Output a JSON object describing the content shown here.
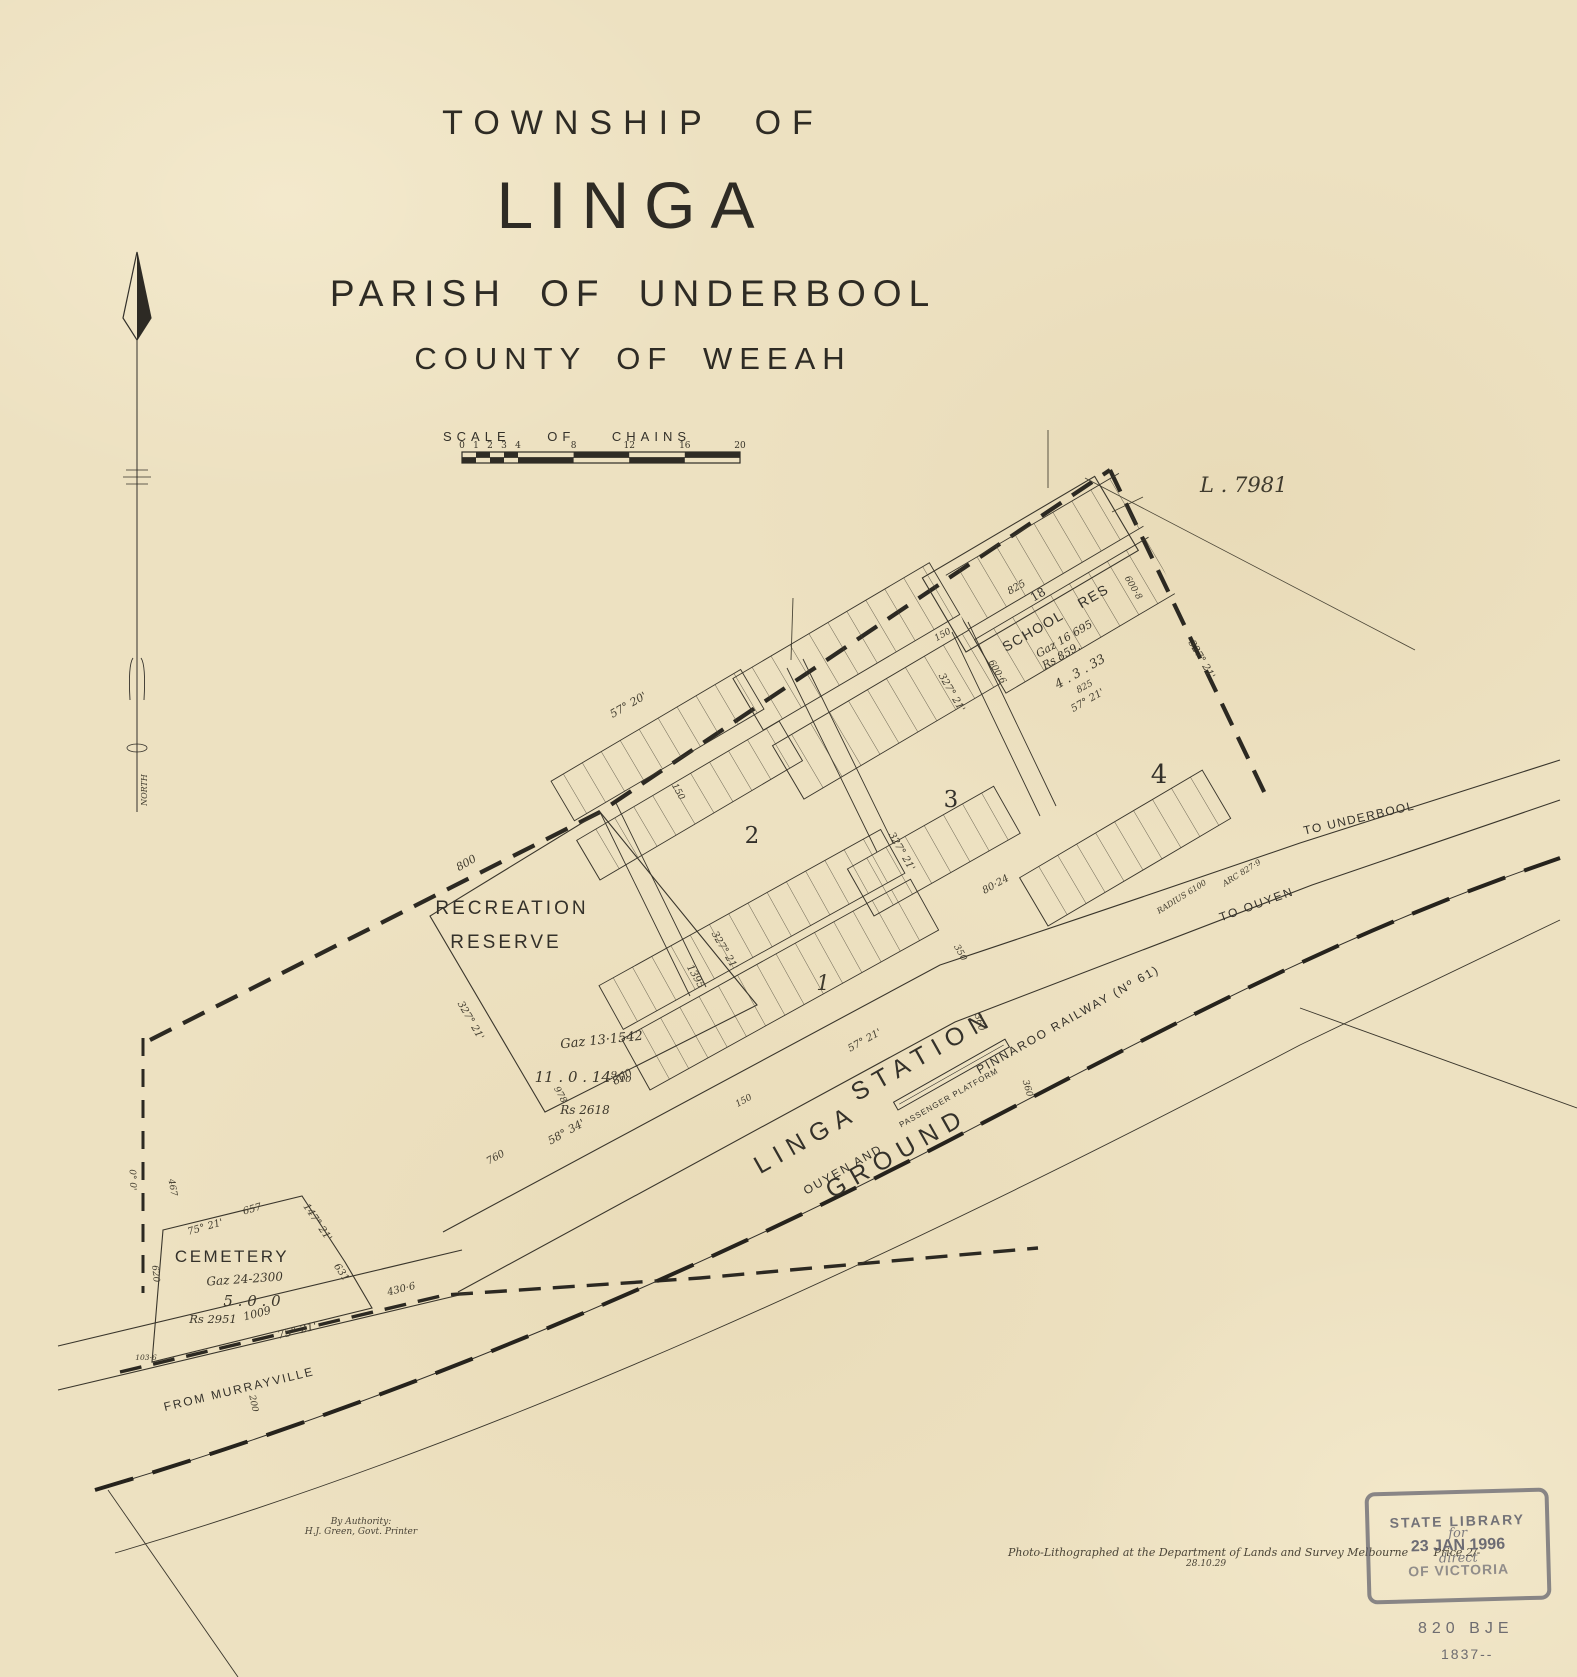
{
  "title": {
    "line1": "TOWNSHIP OF",
    "line2": "LINGA",
    "line3": "PARISH OF UNDERBOOL",
    "line4": "COUNTY OF WEEAH"
  },
  "scale_bar": {
    "label": "SCALE OF CHAINS",
    "ticks": [
      "0",
      "1",
      "2",
      "3",
      "4",
      "8",
      "12",
      "16",
      "20"
    ]
  },
  "plan_ref": "L . 7981",
  "compass_label": "NORTH",
  "sections": {
    "s1": "1",
    "s2": "2",
    "s3": "3",
    "s4": "4"
  },
  "school": {
    "lot": "18",
    "name": "SCHOOL RES",
    "gaz": "Gaz 16 695",
    "rs": "Rs 859.",
    "area": "4 . 3 . 33"
  },
  "recreation": {
    "name1": "RECREATION",
    "name2": "RESERVE",
    "gaz": "Gaz 13·1542",
    "area": "11 . 0 . 14⁹⁄₁₀",
    "rs": "Rs 2618"
  },
  "cemetery": {
    "name": "CEMETERY",
    "gaz": "Gaz 24-2300",
    "area": "5 . 0 . 0",
    "rs": "Rs 2951"
  },
  "station": {
    "word1": "LINGA",
    "word2": "STATION",
    "word3": "GROUND",
    "platform": "PASSENGER PLATFORM"
  },
  "railway": {
    "label1": "OUYEN AND",
    "label2": "PINNAROO RAILWAY (Nº 61)"
  },
  "roads": {
    "underbool": "TO UNDERBOOL",
    "ouyen": "TO OUYEN",
    "murrayville": "FROM MURRAYVILLE"
  },
  "imprint": {
    "authority1": "By Authority:",
    "authority2": "H.J. Green, Govt. Printer",
    "litho": "Photo-Lithographed at the Department of Lands and Survey Melbourne",
    "price": "Price 2/-",
    "date": "28.10.29"
  },
  "stamp": {
    "line1": "STATE LIBRARY",
    "hand1": "for",
    "line2": "23 JAN 1996",
    "hand2": "direct",
    "line3": "OF VICTORIA"
  },
  "catalog": {
    "line1": "820 BJE",
    "line2": "1837--"
  },
  "annotations": [
    {
      "text": "800",
      "x": 468,
      "y": 866,
      "r": -30,
      "s": 11
    },
    {
      "text": "327° 21'",
      "x": 468,
      "y": 1022,
      "r": 60,
      "s": 10
    },
    {
      "text": "1395",
      "x": 693,
      "y": 978,
      "r": 60,
      "s": 10
    },
    {
      "text": "327° 21'",
      "x": 722,
      "y": 952,
      "r": 60,
      "s": 10
    },
    {
      "text": "978",
      "x": 558,
      "y": 1096,
      "r": 60,
      "s": 9
    },
    {
      "text": "800",
      "x": 624,
      "y": 1080,
      "r": -29,
      "s": 11
    },
    {
      "text": "58° 34'",
      "x": 568,
      "y": 1135,
      "r": -29,
      "s": 11
    },
    {
      "text": "760",
      "x": 497,
      "y": 1160,
      "r": -29,
      "s": 10
    },
    {
      "text": "657",
      "x": 253,
      "y": 1212,
      "r": -16,
      "s": 10
    },
    {
      "text": "75° 21'",
      "x": 206,
      "y": 1230,
      "r": -16,
      "s": 10
    },
    {
      "text": "147° 21'",
      "x": 315,
      "y": 1224,
      "r": 56,
      "s": 10
    },
    {
      "text": "631",
      "x": 339,
      "y": 1274,
      "r": 56,
      "s": 10
    },
    {
      "text": "467",
      "x": 170,
      "y": 1188,
      "r": 80,
      "s": 9
    },
    {
      "text": "620",
      "x": 153,
      "y": 1274,
      "r": 84,
      "s": 9
    },
    {
      "text": "0° 0'",
      "x": 130,
      "y": 1180,
      "r": 88,
      "s": 9
    },
    {
      "text": "103·6",
      "x": 146,
      "y": 1360,
      "r": 0,
      "s": 7.5
    },
    {
      "text": "1009",
      "x": 258,
      "y": 1317,
      "r": -14,
      "s": 11
    },
    {
      "text": "75° 21'",
      "x": 298,
      "y": 1334,
      "r": -14,
      "s": 11
    },
    {
      "text": "430·6",
      "x": 402,
      "y": 1292,
      "r": -14,
      "s": 10
    },
    {
      "text": "200",
      "x": 251,
      "y": 1404,
      "r": 78,
      "s": 9
    },
    {
      "text": "57° 20'",
      "x": 630,
      "y": 708,
      "r": -30,
      "s": 11
    },
    {
      "text": "57° 21'",
      "x": 866,
      "y": 1043,
      "r": -29,
      "s": 10
    },
    {
      "text": "150",
      "x": 745,
      "y": 1103,
      "r": -29,
      "s": 9
    },
    {
      "text": "150",
      "x": 944,
      "y": 637,
      "r": -30,
      "s": 9
    },
    {
      "text": "80·24",
      "x": 997,
      "y": 887,
      "r": -29,
      "s": 10
    },
    {
      "text": "350",
      "x": 958,
      "y": 954,
      "r": 60,
      "s": 9
    },
    {
      "text": "360",
      "x": 977,
      "y": 1023,
      "r": 74,
      "s": 9
    },
    {
      "text": "360",
      "x": 1025,
      "y": 1089,
      "r": 74,
      "s": 9
    },
    {
      "text": "RADIUS 6100",
      "x": 1183,
      "y": 899,
      "r": -32,
      "s": 8
    },
    {
      "text": "ARC 827·9",
      "x": 1243,
      "y": 875,
      "r": -32,
      "s": 8
    },
    {
      "text": "327° 21'",
      "x": 1199,
      "y": 661,
      "r": 60,
      "s": 10
    },
    {
      "text": "57° 21'",
      "x": 1089,
      "y": 703,
      "r": -30,
      "s": 10
    },
    {
      "text": "825",
      "x": 1086,
      "y": 689,
      "r": -30,
      "s": 9
    },
    {
      "text": "825",
      "x": 1018,
      "y": 590,
      "r": -30,
      "s": 10
    },
    {
      "text": "600·6",
      "x": 995,
      "y": 673,
      "r": 60,
      "s": 9
    },
    {
      "text": "600·8",
      "x": 1131,
      "y": 589,
      "r": 60,
      "s": 9
    },
    {
      "text": "327° 21'",
      "x": 899,
      "y": 853,
      "r": 60,
      "s": 10
    },
    {
      "text": "327° 21'",
      "x": 949,
      "y": 694,
      "r": 60,
      "s": 10
    },
    {
      "text": "150",
      "x": 676,
      "y": 793,
      "r": 60,
      "s": 9
    }
  ]
}
